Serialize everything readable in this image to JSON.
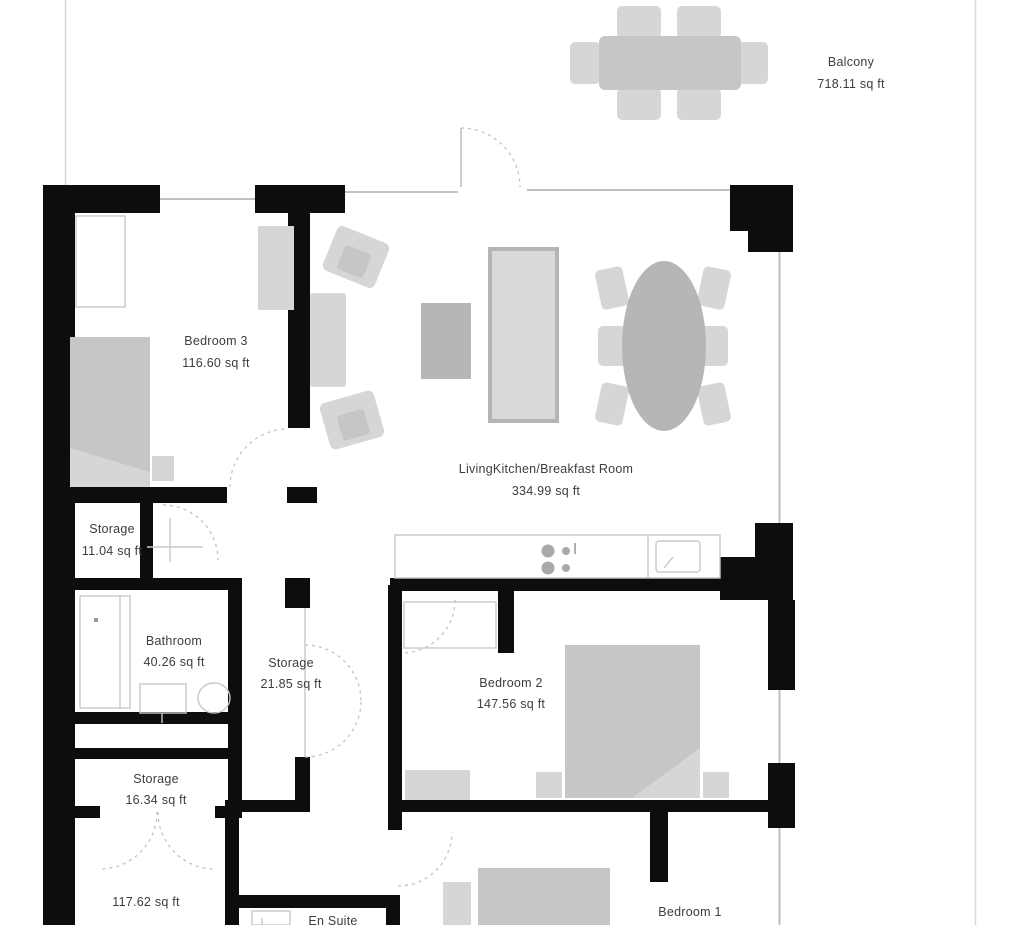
{
  "rooms": {
    "balcony": {
      "name": "Balcony",
      "area": "718.11 sq ft"
    },
    "bedroom3": {
      "name": "Bedroom 3",
      "area": "116.60 sq ft"
    },
    "living": {
      "name": "LivingKitchen/Breakfast Room",
      "area": "334.99 sq ft"
    },
    "storage1": {
      "name": "Storage",
      "area": "11.04 sq ft"
    },
    "bathroom": {
      "name": "Bathroom",
      "area": "40.26 sq ft"
    },
    "storage2": {
      "name": "Storage",
      "area": "21.85 sq ft"
    },
    "bedroom2": {
      "name": "Bedroom 2",
      "area": "147.56 sq ft"
    },
    "storage3": {
      "name": "Storage",
      "area": "16.34 sq ft"
    },
    "hallway": {
      "area": "117.62 sq ft"
    },
    "ensuite": {
      "name": "En Suite"
    },
    "bedroom1": {
      "name": "Bedroom 1"
    }
  },
  "colors": {
    "background": "#ffffff",
    "wall": "#0d0d0d",
    "furniture_light": "#d6d6d6",
    "furniture_mid": "#c6c6c6",
    "furniture_dark": "#b6b6b6",
    "fixture_line": "#c9c9c9",
    "window_line": "#b8b8b8",
    "door_arc": "#c2c2c2",
    "boundary": "#d9d9d9",
    "label": "#3d3d3d"
  }
}
